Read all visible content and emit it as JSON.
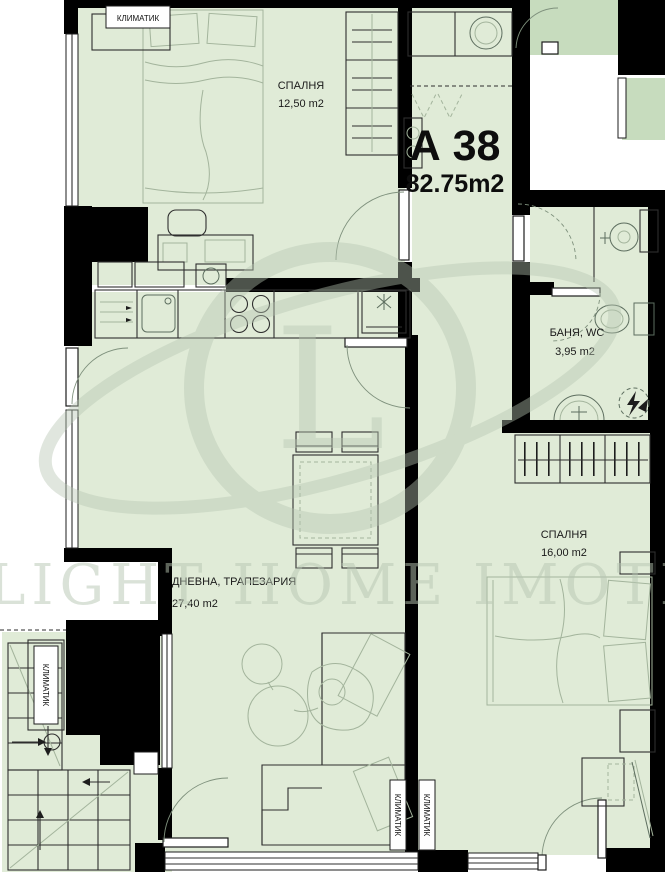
{
  "plan": {
    "apartment": {
      "number": "А 38",
      "area": "82.75m2"
    },
    "rooms": {
      "bedroom1": {
        "name": "СПАЛНЯ",
        "area": "12,50 m2"
      },
      "bathroom": {
        "name": "БАНЯ, WC",
        "area": "3,95 m2"
      },
      "living": {
        "name": "ДНЕВНА, ТРАПЕЗАРИЯ",
        "area": "27,40 m2"
      },
      "bedroom2": {
        "name": "СПАЛНЯ",
        "area": "16,00 m2"
      }
    },
    "ac_label": "КЛИМАТИК",
    "watermark": {
      "letter": "L",
      "text": "LIGHT HOME IMOTI"
    },
    "colors": {
      "int": "#e0ebd7",
      "cor": "#c7dcbe",
      "wm": "#b7c6b2",
      "furnlt": "#a3b49c"
    }
  }
}
